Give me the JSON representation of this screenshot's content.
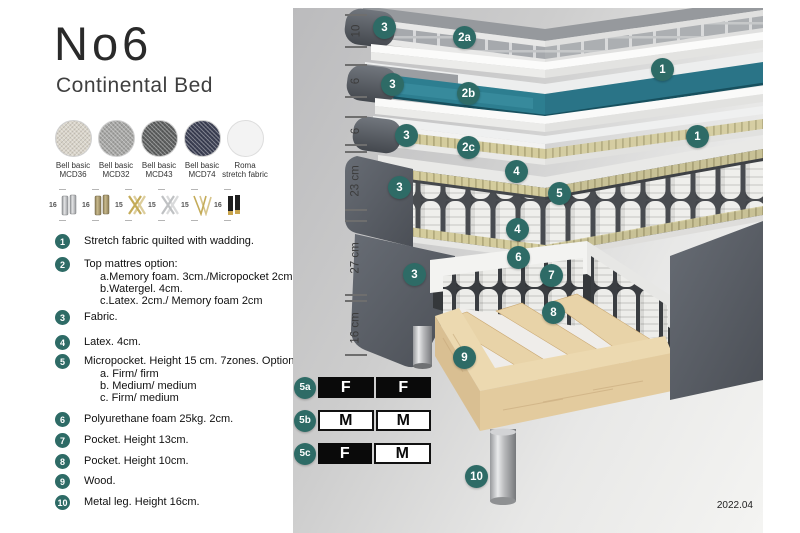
{
  "header": {
    "title": "No6",
    "subtitle": "Continental Bed"
  },
  "swatches": [
    {
      "name": "Bell basic",
      "code": "MCD36",
      "color": "#d9d4c9"
    },
    {
      "name": "Bell basic",
      "code": "MCD32",
      "color": "#a5a5a3"
    },
    {
      "name": "Bell basic",
      "code": "MCD43",
      "color": "#5d5f5f"
    },
    {
      "name": "Bell basic",
      "code": "MCD74",
      "color": "#3b3f53"
    },
    {
      "name": "Roma",
      "code": "stretch fabric",
      "color": "#f3f3f3"
    }
  ],
  "legs": [
    {
      "height": "16",
      "type": "cylinder-silver"
    },
    {
      "height": "16",
      "type": "cylinder-brass"
    },
    {
      "height": "15",
      "type": "cross-gold"
    },
    {
      "height": "15",
      "type": "cross-silver"
    },
    {
      "height": "15",
      "type": "hairpin-gold"
    },
    {
      "height": "16",
      "type": "cylinder-black-gold-tip"
    }
  ],
  "legend": [
    {
      "num": "1",
      "text": "Stretch fabric quilted with wadding.",
      "sub": []
    },
    {
      "num": "2",
      "text": "Top mattres option:",
      "sub": [
        "a.Memory foam. 3cm./Micropocket 2cm",
        "b.Watergel. 4cm.",
        "c.Latex. 2cm./ Memory foam 2cm"
      ]
    },
    {
      "num": "3",
      "text": "Fabric.",
      "sub": []
    },
    {
      "num": "4",
      "text": "Latex. 4cm.",
      "sub": []
    },
    {
      "num": "5",
      "text": "Micropocket. Height 15 cm. 7zones. Option:",
      "sub": [
        "a. Firm/ firm",
        "b. Medium/ medium",
        "c. Firm/ medium"
      ]
    },
    {
      "num": "6",
      "text": "Polyurethane foam 25kg. 2cm.",
      "sub": []
    },
    {
      "num": "7",
      "text": "Pocket. Height 13cm.",
      "sub": []
    },
    {
      "num": "8",
      "text": "Pocket. Height 10cm.",
      "sub": []
    },
    {
      "num": "9",
      "text": "Wood.",
      "sub": []
    },
    {
      "num": "10",
      "text": "Metal leg. Height 16cm.",
      "sub": []
    }
  ],
  "diagram": {
    "dimensions": [
      "10",
      "6",
      "6",
      "23 cm",
      "27 cm",
      "16 cm"
    ],
    "callouts": [
      "3",
      "2a",
      "1",
      "3",
      "2b",
      "1",
      "3",
      "2c",
      "3",
      "4",
      "5",
      "4",
      "6",
      "3",
      "7",
      "8",
      "9",
      "10"
    ],
    "firmness": [
      {
        "label": "5a",
        "cells": [
          {
            "text": "F",
            "variant": "dark"
          },
          {
            "text": "F",
            "variant": "dark"
          }
        ]
      },
      {
        "label": "5b",
        "cells": [
          {
            "text": "M",
            "variant": "light"
          },
          {
            "text": "M",
            "variant": "light"
          }
        ]
      },
      {
        "label": "5c",
        "cells": [
          {
            "text": "F",
            "variant": "dark"
          },
          {
            "text": "M",
            "variant": "light"
          }
        ]
      }
    ],
    "colors": {
      "callout": "#2e6b66",
      "watergel": "#2d7e90",
      "foam": "#d4cc9d",
      "wood": "#ead7ae",
      "fabric_drape": "#575c63"
    }
  },
  "footer": {
    "revision": "2022.04"
  }
}
